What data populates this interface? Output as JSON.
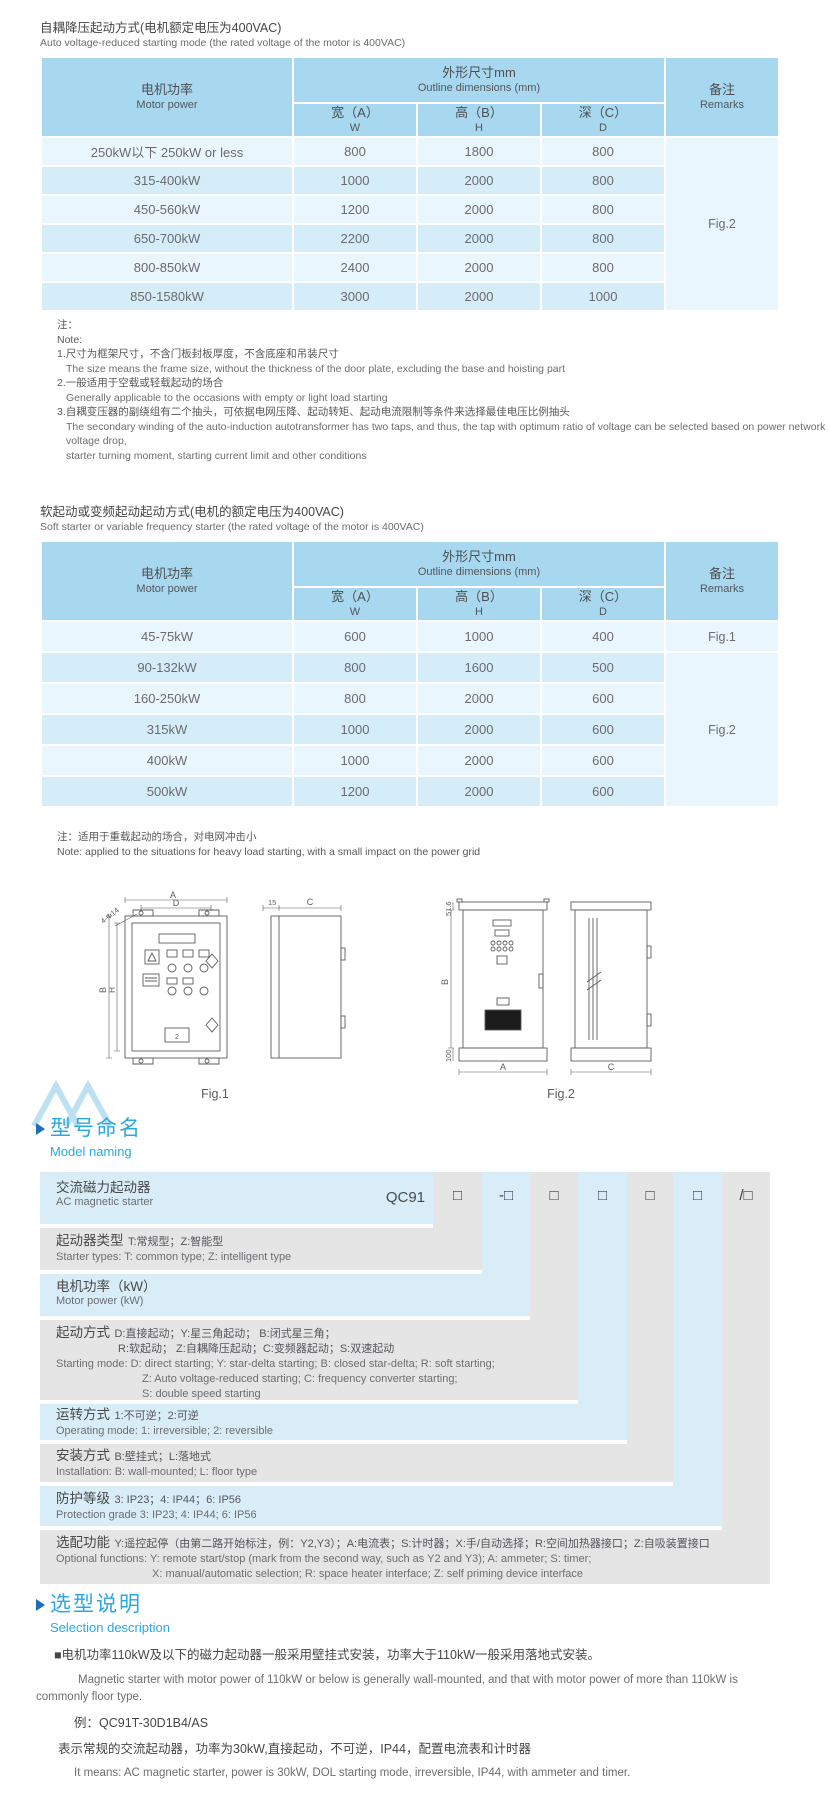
{
  "section1": {
    "title_zh": "自耦降压起动方式(电机额定电压为400VAC)",
    "title_en": "Auto voltage-reduced starting mode (the rated voltage of the motor is 400VAC)",
    "table": {
      "col_motor_zh": "电机功率",
      "col_motor_en": "Motor power",
      "col_dims_zh": "外形尺寸mm",
      "col_dims_en": "Outline dimensions (mm)",
      "col_w_zh": "宽（A）",
      "col_w_en": "W",
      "col_h_zh": "高（B）",
      "col_h_en": "H",
      "col_d_zh": "深（C）",
      "col_d_en": "D",
      "col_remarks_zh": "备注",
      "col_remarks_en": "Remarks",
      "rows": [
        {
          "power": "250kW以下 250kW or less",
          "w": "800",
          "h": "1800",
          "d": "800"
        },
        {
          "power": "315-400kW",
          "w": "1000",
          "h": "2000",
          "d": "800"
        },
        {
          "power": "450-560kW",
          "w": "1200",
          "h": "2000",
          "d": "800"
        },
        {
          "power": "650-700kW",
          "w": "2200",
          "h": "2000",
          "d": "800"
        },
        {
          "power": "800-850kW",
          "w": "2400",
          "h": "2000",
          "d": "800"
        },
        {
          "power": "850-1580kW",
          "w": "3000",
          "h": "2000",
          "d": "1000"
        }
      ],
      "remark": "Fig.2"
    },
    "notes": [
      "注：",
      "Note:",
      "1.尺寸为框架尺寸，不含门板封板厚度，不含底座和吊装尺寸",
      "The size means the frame size, without the thickness of the door plate, excluding the base and hoisting part",
      "2.一般适用于空载或轻载起动的场合",
      "Generally applicable to the occasions with empty or light load starting",
      "3.自耦变压器的副绕组有二个抽头，可依据电网压降、起动转矩、起动电流限制等条件来选择最佳电压比例抽头",
      "The secondary winding of the auto-induction autotransformer has two taps, and thus, the tap with optimum ratio of voltage can be selected based on power network voltage drop,",
      "starter turning moment, starting current limit and other conditions"
    ]
  },
  "section2": {
    "title_zh": "软起动或变频起动起动方式(电机的额定电压为400VAC)",
    "title_en": "Soft starter or variable frequency starter (the rated voltage of the motor is 400VAC)",
    "table": {
      "col_motor_zh": "电机功率",
      "col_motor_en": "Motor power",
      "col_dims_zh": "外形尺寸mm",
      "col_dims_en": "Outline dimensions (mm)",
      "col_w_zh": "宽（A）",
      "col_w_en": "W",
      "col_h_zh": "高（B）",
      "col_h_en": "H",
      "col_d_zh": "深（C）",
      "col_d_en": "D",
      "col_remarks_zh": "备注",
      "col_remarks_en": "Remarks",
      "rows": [
        {
          "power": "45-75kW",
          "w": "600",
          "h": "1000",
          "d": "400"
        },
        {
          "power": "90-132kW",
          "w": "800",
          "h": "1600",
          "d": "500"
        },
        {
          "power": "160-250kW",
          "w": "800",
          "h": "2000",
          "d": "600"
        },
        {
          "power": "315kW",
          "w": "1000",
          "h": "2000",
          "d": "600"
        },
        {
          "power": "400kW",
          "w": "1000",
          "h": "2000",
          "d": "600"
        },
        {
          "power": "500kW",
          "w": "1200",
          "h": "2000",
          "d": "600"
        }
      ],
      "remark_first": "Fig.1",
      "remark_rest": "Fig.2"
    },
    "note_zh": "注：适用于重载起动的场合，对电网冲击小",
    "note_en": "Note: applied to the situations for heavy load starting, with a small impact on the power grid"
  },
  "figures": {
    "fig1": {
      "caption": "Fig.1",
      "panel_label": "2",
      "dims": {
        "a": "A",
        "d": "D",
        "b": "B",
        "h": "H",
        "holes": "4-Φ14",
        "flange": "15",
        "c": "C"
      }
    },
    "fig2": {
      "caption": "Fig.2",
      "dims": {
        "top": "51.6",
        "b": "B",
        "base": "100",
        "a": "A",
        "c": "C"
      }
    }
  },
  "model_naming": {
    "heading_zh": "型号命名",
    "heading_en": "Model naming",
    "product_zh": "交流磁力起动器",
    "product_en": "AC magnetic starter",
    "code_prefix": "QC91",
    "code_boxes": [
      "□",
      "-□",
      "□",
      "□",
      "□",
      "□",
      "/□"
    ],
    "rows": [
      {
        "label": "起动器类型",
        "zh": "T:常规型；Z:智能型",
        "en": [
          "Starter types: T: common type; Z: intelligent type"
        ]
      },
      {
        "label": "电机功率（kW）",
        "zh": "",
        "en": [
          "Motor power (kW)"
        ]
      },
      {
        "label": "起动方式",
        "zh": "D:直接起动；Y:星三角起动；  B:闭式星三角；",
        "zh2": "R:软起动；  Z:自耦降压起动；C:变频器起动；S:双速起动",
        "en": [
          "Starting mode: D: direct starting; Y: star-delta starting; B: closed star-delta; R: soft starting;",
          "Z: Auto voltage-reduced starting; C: frequency converter starting;",
          "S: double speed starting"
        ]
      },
      {
        "label": "运转方式",
        "zh": "1:不可逆；2:可逆",
        "en": [
          "Operating mode: 1: irreversible; 2: reversible"
        ]
      },
      {
        "label": "安装方式",
        "zh": "B:壁挂式；L:落地式",
        "en": [
          "Installation: B: wall-mounted;  L: floor type"
        ]
      },
      {
        "label": "防护等级",
        "zh": "3: IP23；4: IP44；6: IP56",
        "en": [
          "Protection grade  3: IP23;  4: IP44;  6: IP56"
        ]
      },
      {
        "label": "选配功能",
        "zh": "Y:遥控起停（由第二路开始标注，例：Y2,Y3）；A:电流表；S:计时器；X:手/自动选择；R:空间加热器接口；Z:自吸装置接口",
        "en": [
          "Optional functions: Y: remote start/stop (mark from the second way, such as Y2 and Y3); A: ammeter; S: timer;",
          "X: manual/automatic selection; R: space heater interface; Z: self priming device interface"
        ]
      }
    ]
  },
  "selection": {
    "heading_zh": "选型说明",
    "heading_en": "Selection description",
    "p1_zh": "■电机功率110kW及以下的磁力起动器一般采用壁挂式安装，功率大于110kW一般采用落地式安装。",
    "p1_en": "Magnetic starter with motor power of 110kW or below is generally wall-mounted, and that with motor power of more than 110kW is commonly floor type.",
    "example": "例：QC91T-30D1B4/AS",
    "p2_zh": "表示常规的交流起动器，功率为30kW,直接起动，不可逆，IP44，配置电流表和计时器",
    "p2_en": "It means: AC magnetic starter, power is 30kW, DOL starting mode, irreversible, IP44, with ammeter and timer."
  }
}
